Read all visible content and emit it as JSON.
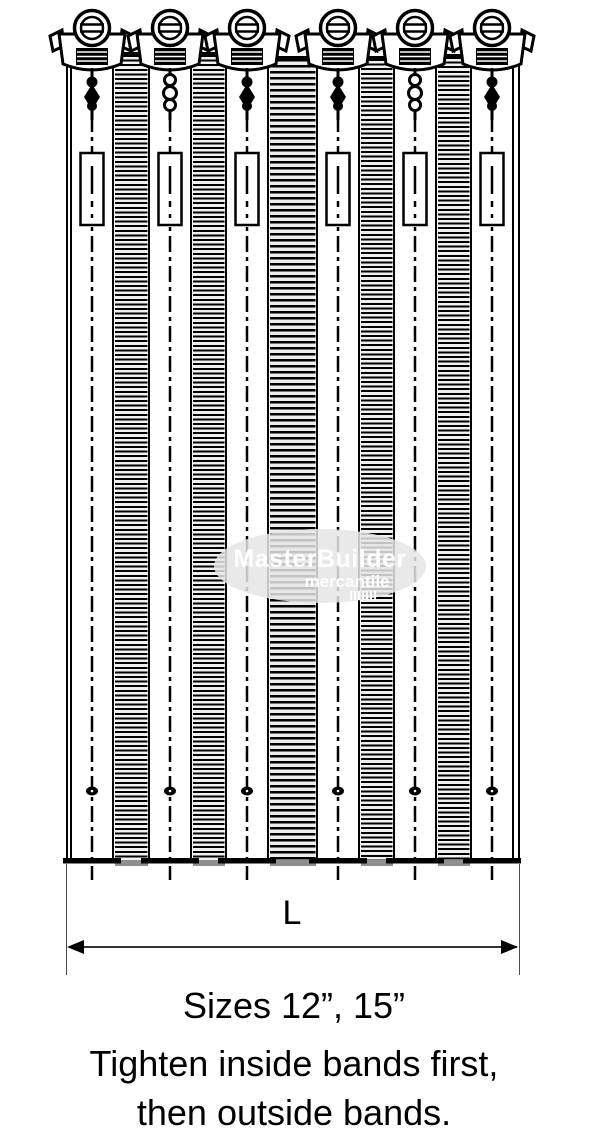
{
  "figure": {
    "dimension": {
      "label": "L"
    },
    "captions": {
      "line1": "Sizes 12”, 15”",
      "line2": "Tighten inside bands first,",
      "line3": "then outside bands."
    },
    "watermark": {
      "line1": "MasterBuilder",
      "line2": "mercantile"
    },
    "bands": {
      "count": 6
    },
    "colors": {
      "ink": "#000000",
      "hatch_fill": "#f0f0f0",
      "watermark_bg": "#e5e5e5",
      "watermark_text": "#ffffff"
    }
  }
}
